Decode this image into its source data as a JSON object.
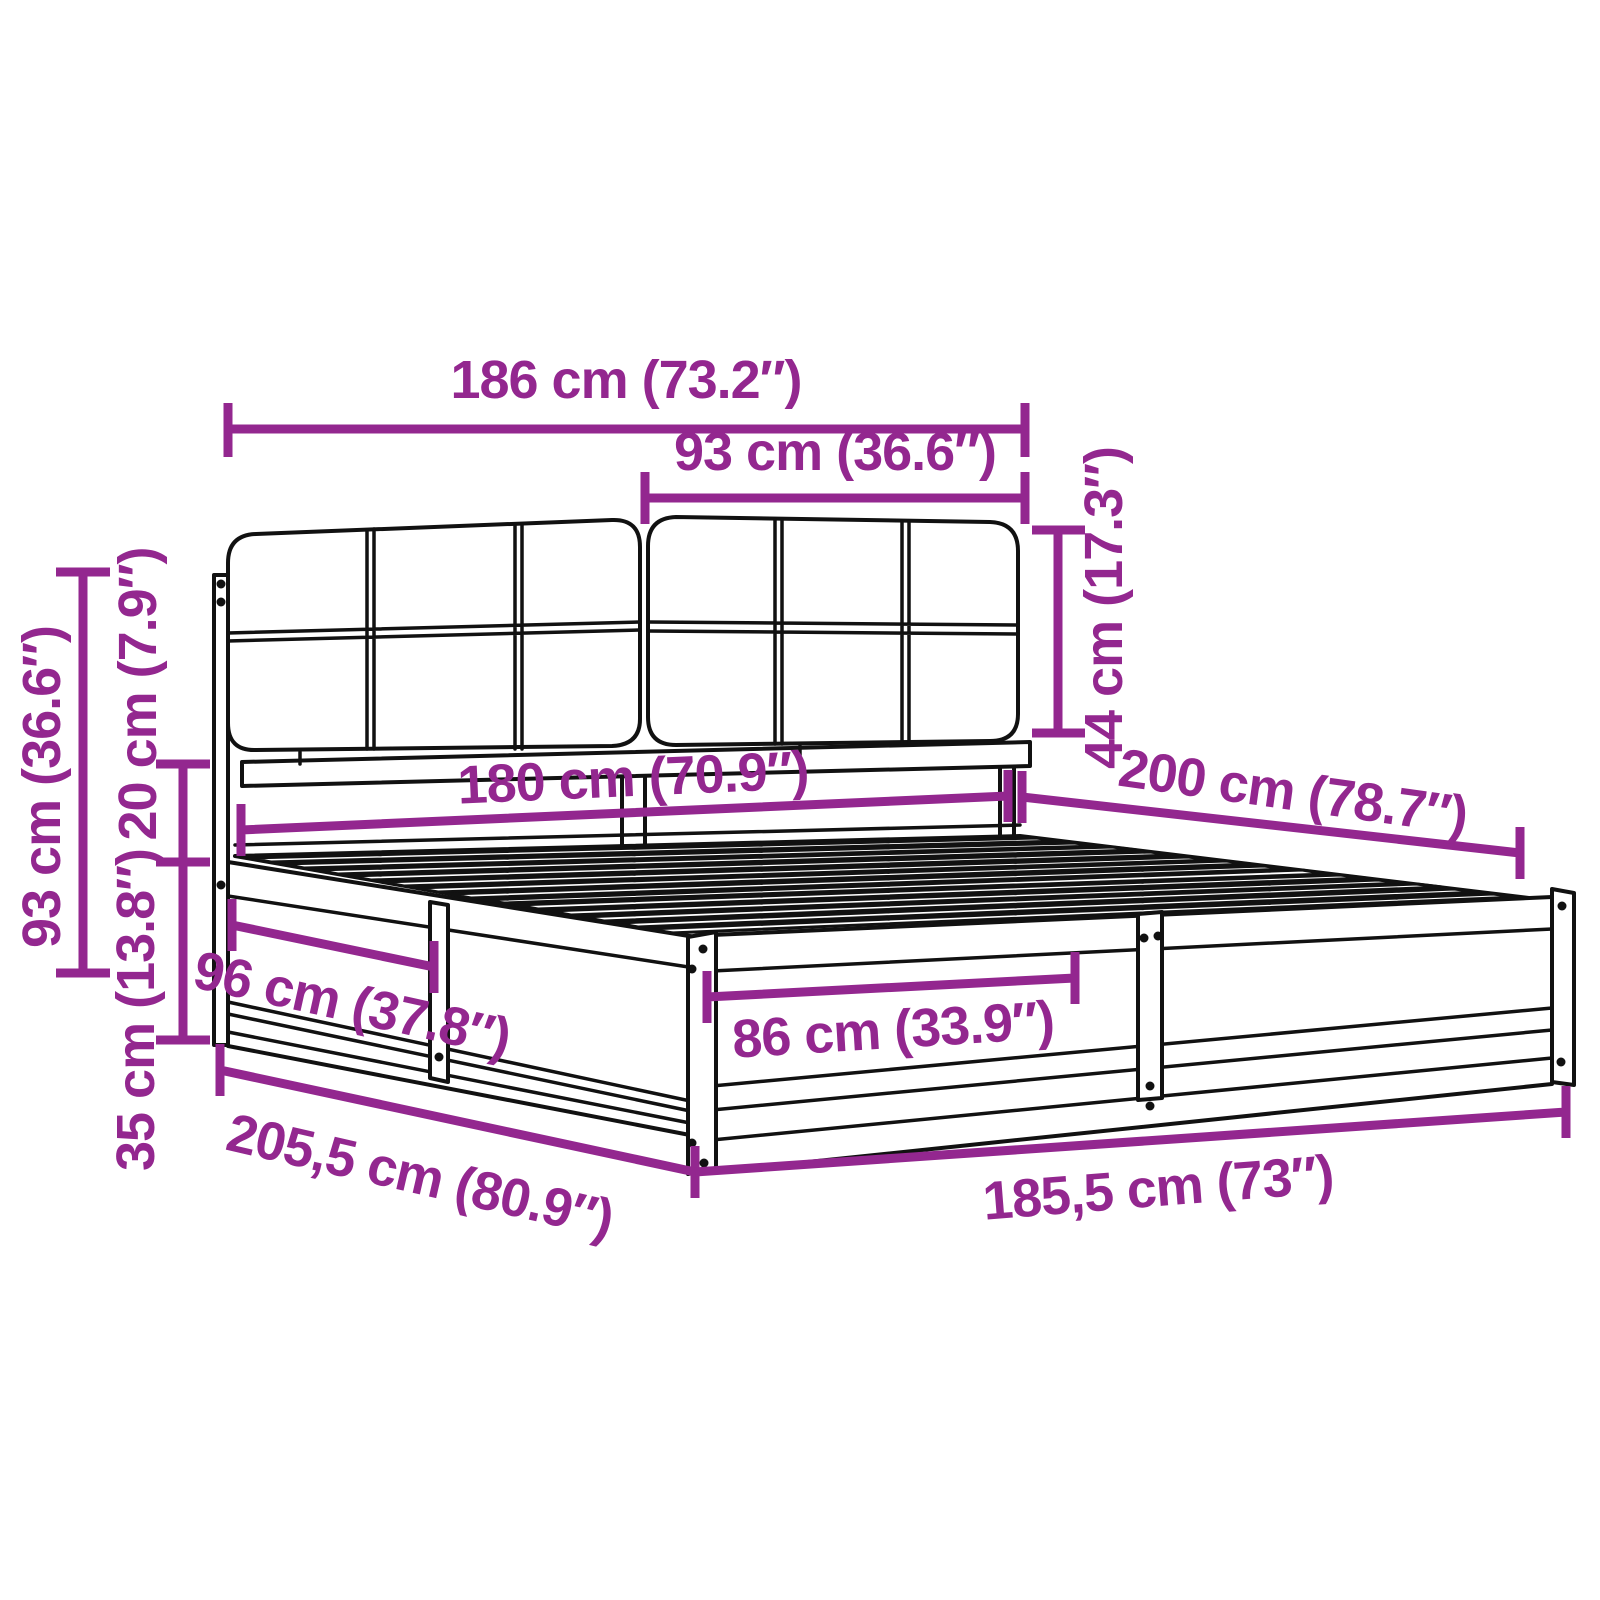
{
  "diagram": {
    "accent_color": "#93278F",
    "outline_color": "#111111",
    "background_color": "#ffffff"
  },
  "dimensions": {
    "headboard_width": "186 cm (73.2″)",
    "headboard_section_width": "93 cm (36.6″)",
    "headboard_cushion_height": "44 cm (17.3″)",
    "headboard_total_height": "93 cm (36.6″)",
    "cushion_to_base_gap": "20 cm (7.9″)",
    "base_frame_height": "35 cm (13.8″)",
    "mattress_width": "180 cm (70.9″)",
    "mattress_length": "200 cm (78.7″)",
    "side_rail_segment": "96 cm (37.8″)",
    "foot_rail_segment": "86 cm (33.9″)",
    "frame_total_length": "205,5 cm (80.9″)",
    "frame_total_width": "185,5 cm (73″)"
  }
}
